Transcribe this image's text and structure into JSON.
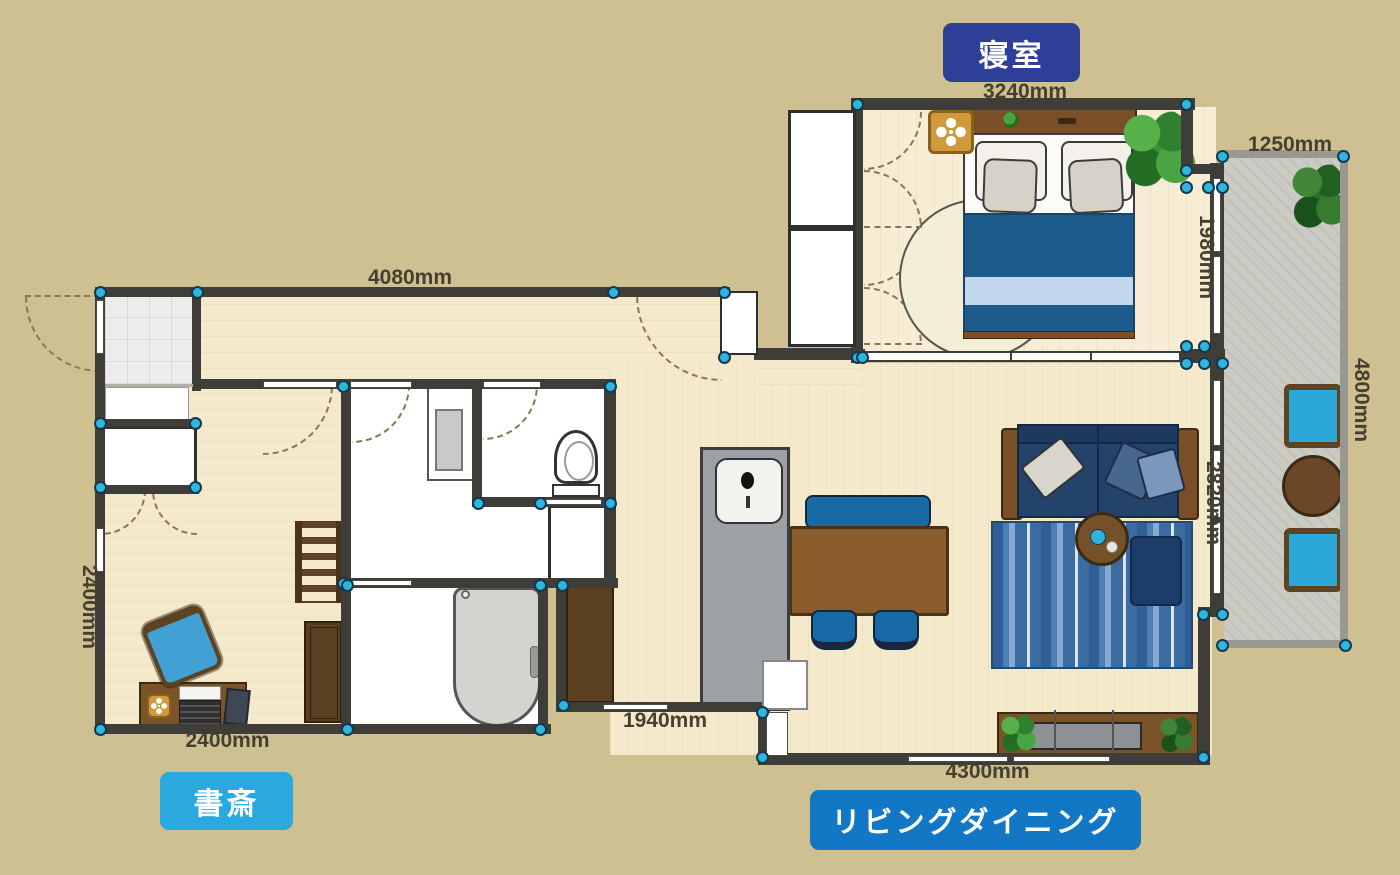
{
  "app": {
    "type": "floor-plan-editor"
  },
  "palette": {
    "background": "#cfc092",
    "wall": "#3f3d38",
    "floor": "#f5e9cc",
    "balcony_floor": "#cbcbc4",
    "vertex_handle": "#2eb6dc",
    "bedroom_badge_bg": "#2d3f96",
    "study_badge_bg": "#29a9dd",
    "living_badge_bg": "#1277c5",
    "dimension_text": "#45402f"
  },
  "room_labels": {
    "bedroom": {
      "text": "寝室"
    },
    "study": {
      "text": "書斎"
    },
    "living_dining": {
      "text": "リビングダイニング"
    }
  },
  "dimensions": {
    "bedroom_width": "3240mm",
    "balcony_width": "1250mm",
    "hallway_width": "4080mm",
    "bedroom_depth": "1980mm",
    "balcony_length": "4800mm",
    "living_depth": "2820mm",
    "study_depth": "2400mm",
    "study_width": "2400mm",
    "kitchen_width": "1940mm",
    "living_width": "4300mm"
  },
  "vertex_handles": [
    [
      100,
      292
    ],
    [
      197,
      292
    ],
    [
      613,
      292
    ],
    [
      724,
      292
    ],
    [
      724,
      357
    ],
    [
      857,
      357
    ],
    [
      857,
      104
    ],
    [
      1186,
      104
    ],
    [
      100,
      423
    ],
    [
      195,
      423
    ],
    [
      100,
      487
    ],
    [
      195,
      487
    ],
    [
      100,
      729
    ],
    [
      347,
      729
    ],
    [
      343,
      583
    ],
    [
      343,
      386
    ],
    [
      610,
      386
    ],
    [
      478,
      503
    ],
    [
      540,
      503
    ],
    [
      610,
      503
    ],
    [
      540,
      585
    ],
    [
      562,
      585
    ],
    [
      347,
      585
    ],
    [
      540,
      729
    ],
    [
      563,
      705
    ],
    [
      762,
      712
    ],
    [
      762,
      757
    ],
    [
      1203,
      757
    ],
    [
      862,
      357
    ],
    [
      1186,
      346
    ],
    [
      1204,
      346
    ],
    [
      1186,
      363
    ],
    [
      1204,
      363
    ],
    [
      1222,
      363
    ],
    [
      1186,
      170
    ],
    [
      1186,
      187
    ],
    [
      1208,
      187
    ],
    [
      1222,
      187
    ],
    [
      1222,
      156
    ],
    [
      1343,
      156
    ],
    [
      1222,
      645
    ],
    [
      1345,
      645
    ],
    [
      1203,
      614
    ],
    [
      1222,
      614
    ]
  ]
}
